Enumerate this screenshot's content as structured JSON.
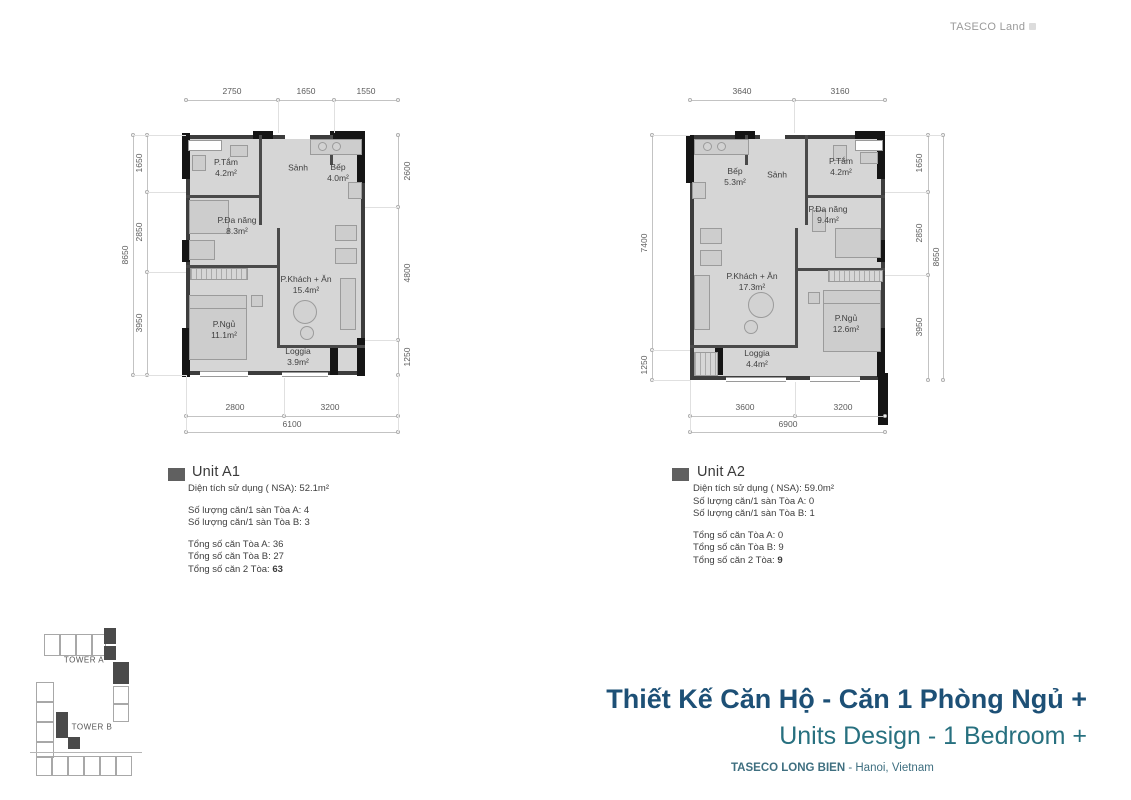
{
  "brand": {
    "logo_text": "TASECO Land"
  },
  "plans": [
    {
      "rooms": {
        "ptam": {
          "name": "P.Tắm",
          "area": "4.2m²"
        },
        "sanh": {
          "name": "Sảnh"
        },
        "bep": {
          "name": "Bếp",
          "area": "4.0m²"
        },
        "danang": {
          "name": "P.Đa năng",
          "area": "8.3m²"
        },
        "khach": {
          "name": "P.Khách + Ăn",
          "area": "15.4m²"
        },
        "ngu": {
          "name": "P.Ngủ",
          "area": "11.1m²"
        },
        "loggia": {
          "name": "Loggia",
          "area": "3.9m²"
        }
      },
      "dims": {
        "top": [
          "2750",
          "1650",
          "1550"
        ],
        "left_total": "8650",
        "left": [
          "1650",
          "2850",
          "3950"
        ],
        "right": [
          "2600",
          "4800",
          "1250"
        ],
        "bottom": [
          "2800",
          "3200"
        ],
        "bottom_total": "6100"
      },
      "legend": {
        "title": "Unit A1",
        "nsa": "Diện tích sử dụng ( NSA): 52.1m²",
        "per_floor": [
          "Số lượng căn/1 sàn Tòa A: 4",
          "Số lượng căn/1 sàn Tòa B: 3"
        ],
        "totals": [
          "Tổng số căn Tòa A: 36",
          "Tổng số căn Tòa B: 27"
        ],
        "grand_label": "Tổng số căn 2 Tòa: ",
        "grand_value": "63"
      }
    },
    {
      "rooms": {
        "bep": {
          "name": "Bếp",
          "area": "5.3m²"
        },
        "sanh": {
          "name": "Sảnh"
        },
        "ptam": {
          "name": "P.Tắm",
          "area": "4.2m²"
        },
        "danang": {
          "name": "P.Đa năng",
          "area": "9.4m²"
        },
        "khach": {
          "name": "P.Khách + Ăn",
          "area": "17.3m²"
        },
        "ngu": {
          "name": "P.Ngủ",
          "area": "12.6m²"
        },
        "loggia": {
          "name": "Loggia",
          "area": "4.4m²"
        }
      },
      "dims": {
        "top": [
          "3640",
          "3160"
        ],
        "left": [
          "7400",
          "1250"
        ],
        "right": [
          "1650",
          "2850",
          "3950"
        ],
        "right_total": "8650",
        "bottom": [
          "3600",
          "3200"
        ],
        "bottom_total": "6900"
      },
      "legend": {
        "title": "Unit A2",
        "nsa": "Diện tích sử dụng ( NSA): 59.0m²",
        "per_floor": [
          "Số lượng căn/1 sàn Tòa A: 0",
          "Số lượng căn/1 sàn Tòa B: 1"
        ],
        "totals": [
          "Tổng số căn Tòa A: 0",
          "Tổng số căn Tòa B: 9"
        ],
        "grand_label": "Tổng số căn 2 Tòa: ",
        "grand_value": "9"
      }
    }
  ],
  "keyplan": {
    "tower_a": "TOWER A",
    "tower_b": "TOWER B"
  },
  "footer": {
    "title_vi": "Thiết Kế Căn Hộ - Căn 1 Phòng Ngủ +",
    "title_en": "Units Design - 1 Bedroom +",
    "project": "TASECO LONG BIEN",
    "location": " - Hanoi, Vietnam"
  },
  "colors": {
    "title_vi": "#1d5076",
    "title_en": "#27707f",
    "floor": "#d6d6d6",
    "wall": "#3d3d3d"
  }
}
